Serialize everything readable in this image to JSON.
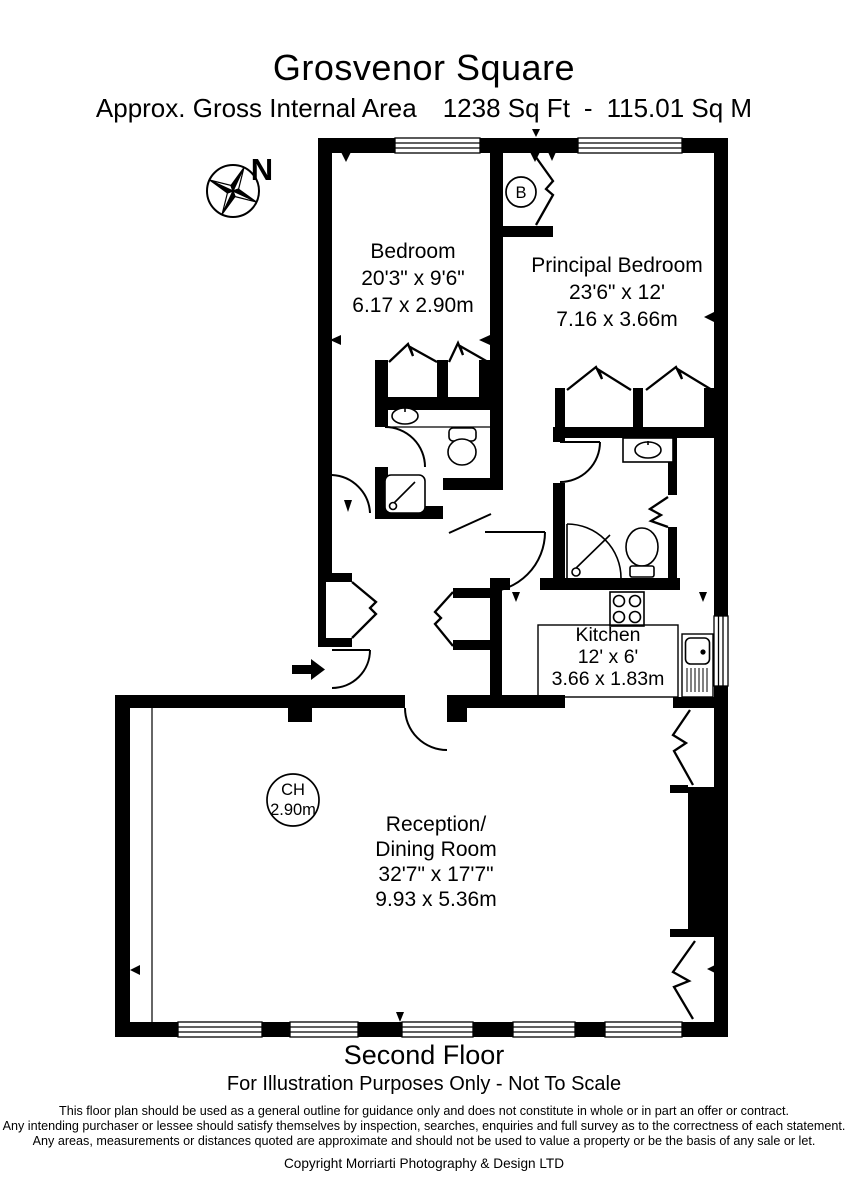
{
  "header": {
    "title": "Grosvenor Square",
    "subtitle": {
      "area_label": "Approx. Gross Internal Area",
      "sq_ft": "1238 Sq Ft",
      "separator": "-",
      "sq_m": "115.01 Sq M"
    }
  },
  "compass": {
    "north_label": "N"
  },
  "plan": {
    "boiler_label": "B",
    "ceiling_height": {
      "abbr": "CH",
      "value": "2.90m"
    },
    "rooms": {
      "bedroom": {
        "name": "Bedroom",
        "imperial": "20'3\" x 9'6\"",
        "metric": "6.17 x 2.90m"
      },
      "principal_bedroom": {
        "name": "Principal Bedroom",
        "imperial": "23'6\" x 12'",
        "metric": "7.16 x 3.66m"
      },
      "kitchen": {
        "name": "Kitchen",
        "imperial": "12' x 6'",
        "metric": "3.66 x 1.83m"
      },
      "reception": {
        "name_line_1": "Reception/",
        "name_line_2": "Dining Room",
        "imperial": "32'7\" x 17'7\"",
        "metric": "9.93 x 5.36m"
      }
    }
  },
  "footer": {
    "floor_label": "Second Floor",
    "scale_note": "For Illustration Purposes Only - Not To Scale",
    "disclaimer_lines": [
      "This floor plan should be used as a general outline for guidance only and does not constitute in whole or in part an offer or contract.",
      "Any intending purchaser or lessee should satisfy themselves by inspection, searches, enquiries and full survey as to the correctness of each statement.",
      "Any areas, measurements or distances quoted are approximate and should not be used to value a property or be the basis of any sale or let."
    ],
    "copyright": "Copyright Morriarti Photography & Design LTD"
  },
  "colors": {
    "ink": "#000000",
    "paper": "#ffffff"
  }
}
